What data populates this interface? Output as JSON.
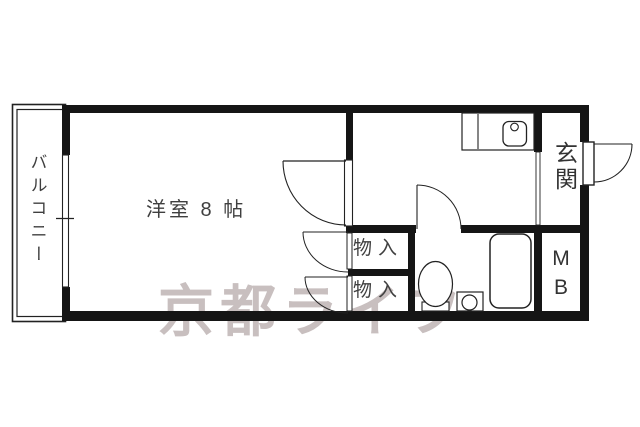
{
  "title": "apartment-floorplan",
  "rooms": {
    "balcony": "バルコニー",
    "western_room": "洋室 8 帖",
    "storage_top": "物入",
    "storage_bottom": "物入",
    "entrance": "玄関",
    "meter_box_m": "M",
    "meter_box_b": "B"
  },
  "watermark": {
    "text": "京都ライフ",
    "color": "#c8bfbf"
  },
  "fixtures": [
    "kitchen-counter",
    "sink-basin",
    "faucet",
    "bathtub",
    "toilet",
    "wash-pan",
    "balcony-window",
    "entrance-door",
    "room-door",
    "closet-doors",
    "bath-door"
  ],
  "colors": {
    "wall": "#151515",
    "line": "#222222",
    "label": "#3f3f3f"
  }
}
